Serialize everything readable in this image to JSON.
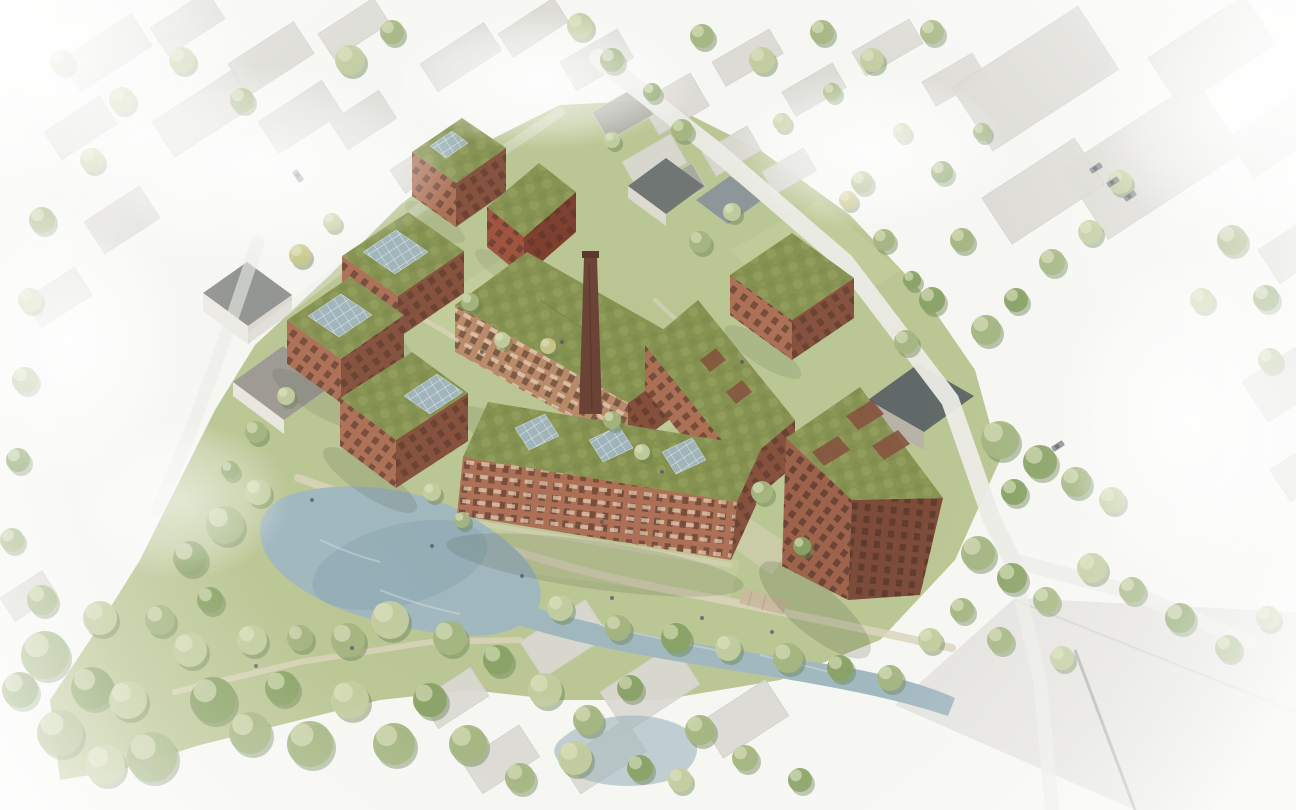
{
  "meta": {
    "title": "Aerial bird's-eye architectural rendering of a new brick housing quarter with green roofs, solar panels, a historic factory chimney, pond and canal, set in a faded watercolor town context"
  },
  "scene": {
    "style": "watercolor architectural visualization, periphery faded to white",
    "new_development": {
      "buildings": [
        {
          "id": "north-small-block",
          "material": "brick",
          "roof": "green roof with solar array"
        },
        {
          "id": "north-red-gable-house",
          "material": "red brick",
          "roof": "green pitched roof"
        },
        {
          "id": "northwest-block-upper",
          "material": "brick",
          "roof": "green roof with solar array"
        },
        {
          "id": "northwest-block-lower",
          "material": "brick",
          "roof": "green roof with solar array"
        },
        {
          "id": "west-block",
          "material": "brick",
          "roof": "green roof with solar array",
          "features": "balconies"
        },
        {
          "id": "center-long-building",
          "material": "tan brick",
          "roof": "green roof",
          "features": "balconies, faces courtyard"
        },
        {
          "id": "east-slab",
          "material": "brick",
          "roof": "green roof with openings"
        },
        {
          "id": "northeast-slab",
          "material": "brick",
          "roof": "green roof"
        },
        {
          "id": "south-long-building",
          "material": "brick",
          "roof": "green roof with three solar arrays",
          "features": "balconies facing canal"
        },
        {
          "id": "south-east-tower",
          "material": "brick",
          "storeys": "approx 7",
          "roof": "large sloped green roof with rectangular openings"
        }
      ],
      "landmark": {
        "id": "factory-chimney",
        "material": "dark brick",
        "shape": "tall slender square shaft"
      }
    },
    "landscape": {
      "pond": "kidney-shaped pond at south-west",
      "canal": "narrow canal running east from pond along south edge",
      "park": "tree-filled park at bottom-left",
      "courtyards": "green courtyards with footpaths between buildings",
      "second_pond": "small faded pond at bottom-center"
    },
    "context": {
      "west_north": "small town houses with gray roofs, washed out to white",
      "north_east": "large industrial halls with pale gray roofs and parked cars",
      "south_east": "large pale industrial roof plane",
      "roads": "street along north-east boundary with junction at east, faded side streets"
    }
  },
  "colors": {
    "background": "#f6f6f3",
    "context_roof": "#d9d8d2",
    "context_roof_dark": "#a7a7a0",
    "context_wall": "#efeee9",
    "grass": "#b5c28c",
    "grass_light": "#cbd3a2",
    "tree_shadow": "#69804f",
    "tree_light": "#c2cc9e",
    "tree_mid": "#a3b47e",
    "tree_dark": "#87a062",
    "tree_yellow": "#c9c788",
    "tree_highlight": "#dde3c0",
    "water": "#9fb6bd",
    "water_deep": "#86a0aa",
    "brick_light": "#b98a68",
    "brick_mid": "#ab6f54",
    "brick_dark": "#84503c",
    "brick_red": "#9e523c",
    "brick_red_dark": "#7c3d2d",
    "roof_green": "#84914f",
    "roof_green_light": "#a9b272",
    "roof_green_dark": "#6e7e44",
    "solar": "#9fb4ba",
    "chimney": "#6b4236",
    "dark_roof": "#5d6664",
    "road": "#ebebe6",
    "path": "#d9d2ba",
    "shadow": "#3c4a2e",
    "window_dark": "#40291e",
    "deck": "#c9b79b",
    "car": "#7d8286"
  },
  "trees": [
    [
      45,
      655,
      24,
      1
    ],
    [
      92,
      688,
      21,
      2
    ],
    [
      60,
      733,
      23,
      1
    ],
    [
      128,
      700,
      19,
      0
    ],
    [
      152,
      757,
      25,
      1
    ],
    [
      213,
      700,
      23,
      2
    ],
    [
      190,
      650,
      17,
      0
    ],
    [
      250,
      733,
      21,
      1
    ],
    [
      282,
      688,
      17,
      2
    ],
    [
      310,
      744,
      23,
      1
    ],
    [
      350,
      700,
      19,
      0
    ],
    [
      394,
      744,
      21,
      1
    ],
    [
      430,
      700,
      17,
      2
    ],
    [
      468,
      744,
      19,
      1
    ],
    [
      252,
      640,
      15,
      0
    ],
    [
      300,
      638,
      13,
      1
    ],
    [
      210,
      600,
      13,
      2
    ],
    [
      160,
      620,
      15,
      1
    ],
    [
      100,
      618,
      17,
      0
    ],
    [
      42,
      600,
      15,
      1
    ],
    [
      20,
      690,
      18,
      2
    ],
    [
      105,
      765,
      20,
      0
    ],
    [
      225,
      525,
      19,
      1
    ],
    [
      190,
      558,
      17,
      2
    ],
    [
      258,
      492,
      13,
      0
    ],
    [
      450,
      638,
      17,
      1
    ],
    [
      498,
      660,
      15,
      2
    ],
    [
      390,
      620,
      19,
      0
    ],
    [
      348,
      640,
      17,
      1
    ],
    [
      545,
      690,
      17,
      0
    ],
    [
      588,
      720,
      15,
      1
    ],
    [
      630,
      688,
      13,
      2
    ],
    [
      575,
      758,
      17,
      0
    ],
    [
      520,
      778,
      15,
      1
    ],
    [
      640,
      768,
      13,
      2
    ],
    [
      700,
      730,
      15,
      1
    ],
    [
      680,
      780,
      12,
      0
    ],
    [
      745,
      758,
      13,
      1
    ],
    [
      800,
      780,
      12,
      2
    ],
    [
      560,
      608,
      13,
      0
    ],
    [
      618,
      628,
      13,
      1
    ],
    [
      676,
      638,
      15,
      2
    ],
    [
      728,
      648,
      13,
      0
    ],
    [
      788,
      658,
      15,
      1
    ],
    [
      840,
      668,
      13,
      2
    ],
    [
      890,
      678,
      13,
      1
    ],
    [
      930,
      640,
      12,
      0
    ],
    [
      962,
      610,
      12,
      1
    ],
    [
      978,
      553,
      17,
      1
    ],
    [
      1012,
      578,
      15,
      2
    ],
    [
      1046,
      600,
      13,
      1
    ],
    [
      1092,
      568,
      15,
      0
    ],
    [
      1132,
      590,
      13,
      1
    ],
    [
      1180,
      618,
      15,
      2
    ],
    [
      1228,
      648,
      13,
      1
    ],
    [
      1268,
      618,
      12,
      0
    ],
    [
      1000,
      640,
      13,
      1
    ],
    [
      1062,
      658,
      12,
      0
    ],
    [
      1000,
      440,
      19,
      1
    ],
    [
      1040,
      462,
      17,
      2
    ],
    [
      1076,
      482,
      15,
      1
    ],
    [
      1112,
      500,
      13,
      0
    ],
    [
      1014,
      492,
      13,
      2
    ],
    [
      986,
      330,
      15,
      1
    ],
    [
      1016,
      300,
      12,
      2
    ],
    [
      1052,
      262,
      13,
      1
    ],
    [
      1090,
      232,
      12,
      0
    ],
    [
      962,
      240,
      12,
      1
    ],
    [
      932,
      300,
      13,
      2
    ],
    [
      906,
      342,
      12,
      1
    ],
    [
      1232,
      240,
      15,
      1
    ],
    [
      1266,
      298,
      13,
      2
    ],
    [
      1202,
      300,
      12,
      0
    ],
    [
      1270,
      360,
      12,
      1
    ],
    [
      1120,
      182,
      12,
      0
    ],
    [
      350,
      60,
      15,
      0
    ],
    [
      392,
      32,
      12,
      1
    ],
    [
      580,
      26,
      13,
      0
    ],
    [
      612,
      60,
      12,
      2
    ],
    [
      702,
      36,
      12,
      1
    ],
    [
      762,
      60,
      13,
      0
    ],
    [
      822,
      32,
      12,
      1
    ],
    [
      872,
      60,
      12,
      0
    ],
    [
      932,
      32,
      12,
      1
    ],
    [
      182,
      60,
      13,
      0
    ],
    [
      242,
      100,
      12,
      1
    ],
    [
      122,
      100,
      13,
      0
    ],
    [
      62,
      62,
      12,
      1
    ],
    [
      92,
      160,
      12,
      0
    ],
    [
      42,
      220,
      13,
      1
    ],
    [
      30,
      300,
      12,
      0
    ],
    [
      25,
      380,
      13,
      1
    ],
    [
      18,
      460,
      12,
      2
    ],
    [
      12,
      540,
      12,
      1
    ],
    [
      300,
      255,
      11,
      3
    ],
    [
      332,
      222,
      9,
      0
    ],
    [
      470,
      302,
      9,
      1
    ],
    [
      502,
      340,
      8,
      0
    ],
    [
      548,
      346,
      8,
      3
    ],
    [
      612,
      420,
      9,
      1
    ],
    [
      642,
      452,
      8,
      0
    ],
    [
      762,
      492,
      11,
      1
    ],
    [
      802,
      546,
      9,
      2
    ],
    [
      432,
      492,
      9,
      0
    ],
    [
      462,
      520,
      8,
      1
    ],
    [
      256,
      432,
      11,
      1
    ],
    [
      230,
      470,
      9,
      2
    ],
    [
      286,
      396,
      9,
      0
    ],
    [
      700,
      242,
      11,
      1
    ],
    [
      732,
      212,
      9,
      0
    ],
    [
      682,
      130,
      11,
      1
    ],
    [
      652,
      92,
      9,
      2
    ],
    [
      612,
      140,
      8,
      0
    ],
    [
      862,
      182,
      11,
      1
    ],
    [
      902,
      132,
      9,
      0
    ],
    [
      942,
      172,
      11,
      2
    ],
    [
      982,
      132,
      9,
      1
    ],
    [
      782,
      122,
      9,
      0
    ],
    [
      832,
      92,
      9,
      1
    ],
    [
      848,
      200,
      9,
      3
    ],
    [
      884,
      240,
      11,
      1
    ],
    [
      912,
      280,
      9,
      2
    ]
  ],
  "context_roofs": [
    [
      60,
      60,
      85,
      38,
      -33,
      0
    ],
    [
      150,
      28,
      68,
      33,
      -33,
      0
    ],
    [
      228,
      64,
      78,
      38,
      -33,
      0
    ],
    [
      318,
      34,
      66,
      30,
      -33,
      0
    ],
    [
      152,
      122,
      95,
      42,
      -33,
      0
    ],
    [
      258,
      122,
      76,
      38,
      -33,
      0
    ],
    [
      44,
      132,
      66,
      33,
      -33,
      0
    ],
    [
      330,
      122,
      58,
      33,
      -33,
      0
    ],
    [
      420,
      64,
      76,
      33,
      -33,
      0
    ],
    [
      498,
      34,
      66,
      28,
      -33,
      0
    ],
    [
      390,
      170,
      66,
      28,
      -33,
      0
    ],
    [
      84,
      222,
      66,
      38,
      -33,
      0
    ],
    [
      24,
      300,
      60,
      33,
      -33,
      0
    ],
    [
      560,
      62,
      66,
      33,
      -30,
      0
    ],
    [
      640,
      102,
      58,
      38,
      -30,
      0
    ],
    [
      712,
      62,
      66,
      28,
      -30,
      0
    ],
    [
      782,
      92,
      58,
      28,
      -30,
      0
    ],
    [
      852,
      52,
      66,
      28,
      -30,
      0
    ],
    [
      922,
      82,
      58,
      28,
      -30,
      0
    ],
    [
      622,
      162,
      56,
      33,
      -30,
      0
    ],
    [
      702,
      152,
      52,
      28,
      -30,
      0
    ],
    [
      762,
      172,
      48,
      26,
      -30,
      0
    ],
    [
      592,
      112,
      52,
      33,
      -30,
      1
    ],
    [
      652,
      186,
      46,
      28,
      -30,
      1
    ],
    [
      952,
      88,
      150,
      75,
      -33,
      0
    ],
    [
      1062,
      168,
      160,
      85,
      -33,
      0
    ],
    [
      982,
      198,
      110,
      55,
      -33,
      0
    ],
    [
      1148,
      58,
      115,
      58,
      -33,
      0
    ],
    [
      1228,
      138,
      88,
      48,
      -33,
      0
    ],
    [
      1258,
      250,
      70,
      40,
      -33,
      0
    ],
    [
      1242,
      382,
      78,
      48,
      -33,
      0
    ],
    [
      1270,
      470,
      68,
      38,
      -33,
      0
    ],
    [
      520,
      642,
      78,
      43,
      -33,
      0
    ],
    [
      600,
      692,
      88,
      48,
      -33,
      0
    ],
    [
      700,
      722,
      78,
      43,
      -33,
      0
    ],
    [
      560,
      762,
      78,
      38,
      -33,
      0
    ],
    [
      462,
      762,
      68,
      38,
      -33,
      0
    ],
    [
      420,
      700,
      60,
      34,
      -33,
      0
    ],
    [
      0,
      598,
      50,
      28,
      -33,
      0
    ]
  ],
  "cars": [
    [
      1096,
      168,
      -33
    ],
    [
      1113,
      182,
      -33
    ],
    [
      1130,
      196,
      -33
    ],
    [
      298,
      176,
      55
    ],
    [
      1058,
      446,
      -33
    ]
  ],
  "people": [
    [
      432,
      546
    ],
    [
      522,
      576
    ],
    [
      612,
      598
    ],
    [
      702,
      618
    ],
    [
      772,
      632
    ],
    [
      312,
      500
    ],
    [
      256,
      666
    ],
    [
      352,
      648
    ],
    [
      602,
      522
    ],
    [
      662,
      472
    ],
    [
      482,
      352
    ],
    [
      562,
      342
    ],
    [
      742,
      362
    ]
  ]
}
